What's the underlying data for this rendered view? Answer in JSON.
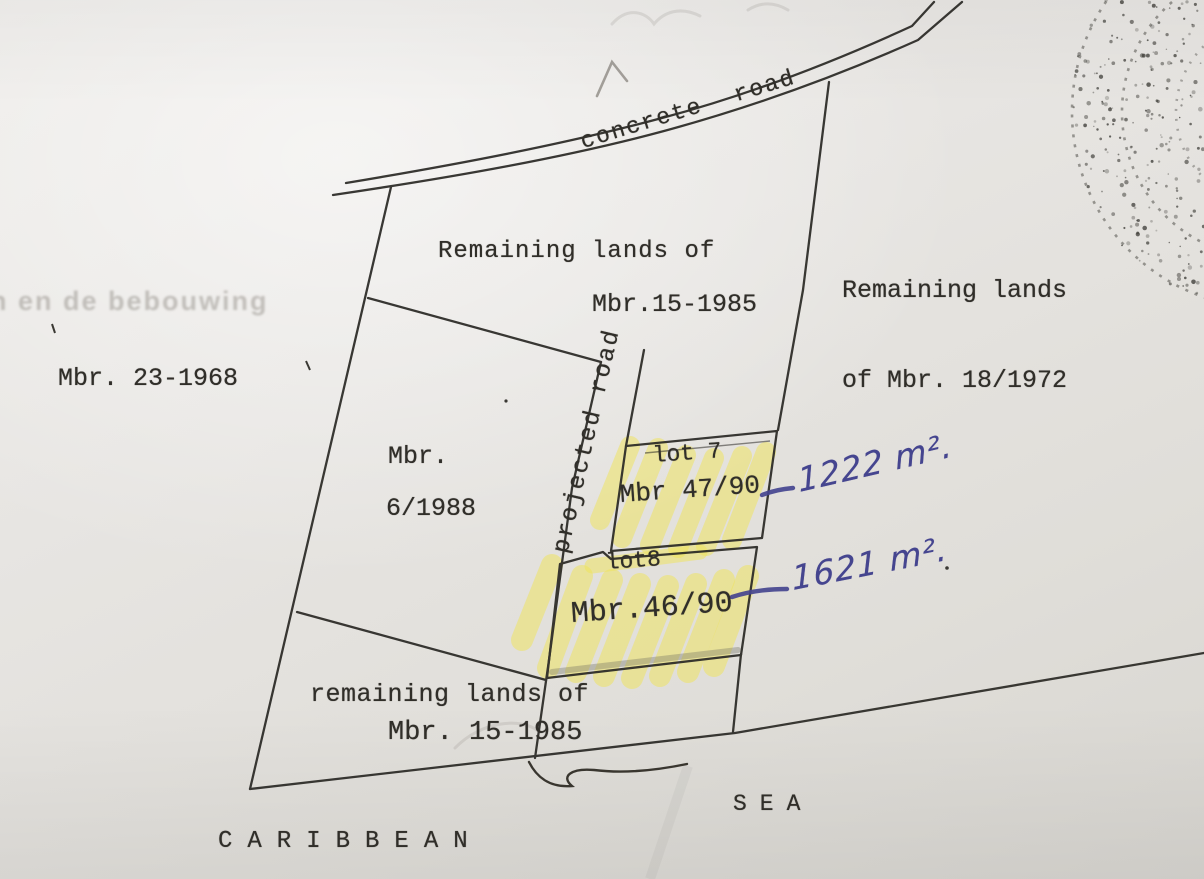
{
  "plan": {
    "roads": {
      "concrete": {
        "word1": "concrete",
        "word2": "road"
      },
      "projected": "projected road"
    },
    "parcels": {
      "top_remaining": {
        "line1": "Remaining lands of",
        "line2": "Mbr.15-1985"
      },
      "east_remaining": {
        "line1": "Remaining lands",
        "line2": "of Mbr. 18/1972"
      },
      "west_outside": {
        "label": "Mbr. 23-1968"
      },
      "center": {
        "line1": "Mbr.",
        "line2": "6/1988"
      },
      "lot7": {
        "name": "lot 7",
        "registration": "Mbr 47/90",
        "area": "1222 m²."
      },
      "lot8": {
        "name": "lot8",
        "registration": "Mbr.46/90",
        "area": "1621 m²."
      },
      "south_remaining": {
        "line1": "remaining lands of",
        "line2": "Mbr. 15-1985"
      }
    },
    "sea": {
      "word1": "CARIBBEAN",
      "word2": "SEA"
    },
    "bleed_through_text": "n en de bebouwing",
    "ink_color": "#45458f",
    "highlight_color": "#efe356"
  }
}
